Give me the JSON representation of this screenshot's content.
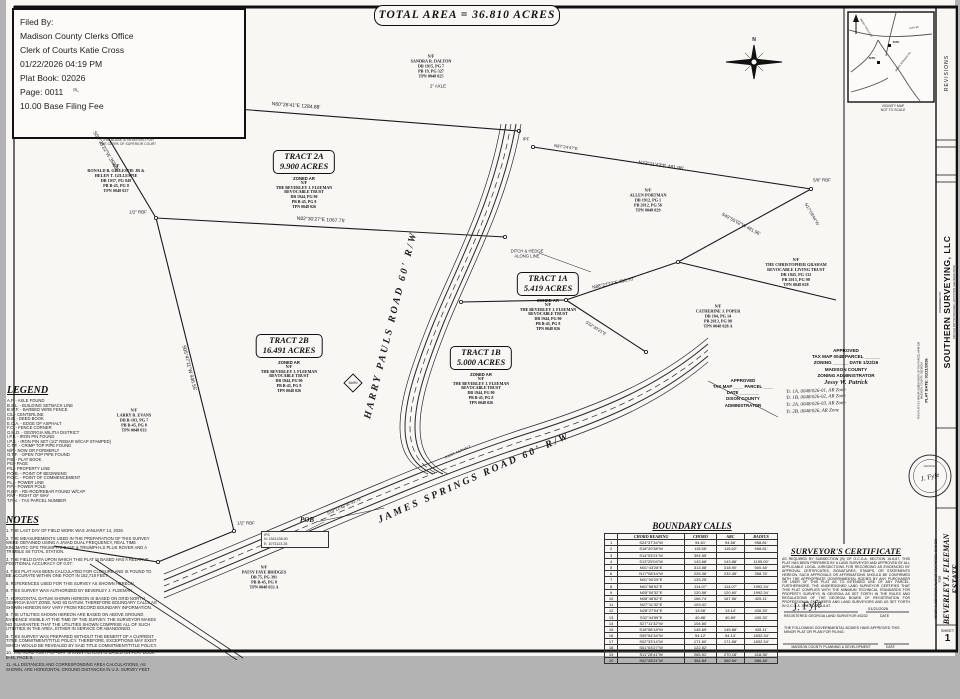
{
  "doc": {
    "total_area": "TOTAL AREA  =  36.810 ACRES",
    "sheet_label": "SHEET",
    "sheet_no": "1"
  },
  "filed_box": {
    "lines": [
      "Filed By:",
      "Madison County Clerks Office",
      "Clerk of Courts Katie Cross",
      "01/22/2026 04:19 PM",
      "Plat Book: 02026",
      "Page: 0011",
      "10.00 Base Filing Fee"
    ]
  },
  "clerk_caption": [
    "THIS BLANK IS RESERVED FOR",
    "THE CLERK OF SUPERIOR COURT"
  ],
  "compass": {
    "label": "N"
  },
  "vicinity": {
    "site1": "SITE",
    "site2": "SITE",
    "road1": "JAMES SPRINGS RD",
    "road2": "HARRY PAULS RD",
    "road3": "HWY 98",
    "cap1": "VICINITY MAP",
    "cap2": "NOT TO SCALE"
  },
  "title_block": {
    "revisions": "REVISIONS",
    "prepared_by": "PREPARED BY",
    "company": "SOUTHERN SURVEYING, LLC",
    "address": "198 OLD ROYSTON ROAD  •  ROYSTON, GEORGIA 30662",
    "plat_date": "PLAT DATE: 01/21/2026",
    "plat_note1": "THIS PLAT IS A MINOR SUBDIVISION OF TAX PARCEL 0048 026",
    "plat_note2": "MADISON COUNTY, GEORGIA",
    "seal_text": "GEORGIA",
    "seal_sig": "J. Fyfe",
    "project1": "MINOR SUBDIVISION PLAT OF TAX PARCEL 0048 026",
    "project2": "FOR",
    "client1": "BEVERLEY J. FLEEMAN",
    "client2": "ESTATE"
  },
  "roads": {
    "harry": "HARRY PAULS ROAD  60' R/W",
    "james": "JAMES SPRINGS ROAD  60' R/W"
  },
  "pob": {
    "lines": [
      "IPS",
      "N: 1541438.50",
      "E: 1073123.26"
    ]
  },
  "plat": {
    "tracts": [
      {
        "x": 298,
        "y": 150,
        "name": "TRACT  2A",
        "acres": "9.900 ACRES",
        "zoned": "ZONED AR",
        "owner": [
          "N/F",
          "THE BEVERLEY J. FLEEMAN",
          "REVOCABLE TRUST",
          "DB 1944, PG 90",
          "PB B-45, PG 8",
          "TPN 0048 026"
        ]
      },
      {
        "x": 542,
        "y": 272,
        "name": "TRACT  1A",
        "acres": "5.419 ACRES",
        "zoned": "ZONED AR",
        "owner": [
          "N/F",
          "THE BEVERLEY J. FLEEMAN",
          "REVOCABLE TRUST",
          "DB 1944, PG 90",
          "PB B-45, PG 8",
          "TPN 0048 026"
        ]
      },
      {
        "x": 283,
        "y": 334,
        "name": "TRACT  2B",
        "acres": "16.491 ACRES",
        "zoned": "ZONED AR",
        "owner": [
          "N/F",
          "THE BEVERLEY J. FLEEMAN",
          "REVOCABLE TRUST",
          "DB 1944, PG 90",
          "PB B-45, PG 8",
          "TPN 0048 026"
        ]
      },
      {
        "x": 475,
        "y": 346,
        "name": "TRACT  1B",
        "acres": "5.000 ACRES",
        "zoned": "ZONED AR",
        "owner": [
          "N/F",
          "THE BEVERLEY J. FLEEMAN",
          "REVOCABLE TRUST",
          "DB 1944, PG 90",
          "PB B-45, PG 8",
          "TPN 0048 026"
        ]
      }
    ],
    "neighbors": [
      {
        "x": 425,
        "y": 66,
        "lines": [
          "N/F",
          "SANDRA R. DALTON",
          "DB 1915, PG 7",
          "PB 19, PG 327",
          "TPN 0048 025"
        ]
      },
      {
        "x": 110,
        "y": 178,
        "lines": [
          "N/F",
          "RONALD B. GILLESPIE JR &",
          "HELEN T. GILLESPIE",
          "DB 1937, PG 849",
          "PB B-45, PG 8",
          "TPN 0048 027"
        ]
      },
      {
        "x": 642,
        "y": 200,
        "lines": [
          "N/F",
          "ALLEN PORTMAN",
          "DB 1912, PG 1",
          "PB 2012, PG 56",
          "TPN 0048 029"
        ]
      },
      {
        "x": 790,
        "y": 272,
        "lines": [
          "N/F",
          "THE CHRISTOPHER GRAHAM",
          "REVOCABLE LIVING TRUST",
          "DB 1845, PG 132",
          "PB 2015, PG 98",
          "TPN 0048 028"
        ]
      },
      {
        "x": 712,
        "y": 316,
        "lines": [
          "N/F",
          "CATHERINE J. POPER",
          "DB 184, PG 14",
          "PB 2013, PG 98",
          "TPN 0048 028 A"
        ]
      },
      {
        "x": 128,
        "y": 420,
        "lines": [
          "N/F",
          "LARRY R. EVANS",
          "DB B-103, PG 7",
          "PB B-45, PG 8",
          "TPN 0048 033"
        ]
      },
      {
        "x": 258,
        "y": 577,
        "lines": [
          "N/F",
          "PATSY FAYE BRIDGES",
          "DB 75, PG 391",
          "PB B-45, PG 8",
          "TPN 0048 033 A"
        ]
      }
    ],
    "labels": [
      {
        "t": "N60°26'41\"E  1284.88'",
        "x": 290,
        "y": 106,
        "r": 4,
        "fs": 5
      },
      {
        "t": "N82°30'27\"E  1067.75'",
        "x": 315,
        "y": 220,
        "r": 3,
        "fs": 5
      },
      {
        "t": "N73°11'43\"E  481.96'",
        "x": 655,
        "y": 166,
        "r": 8,
        "fs": 5
      },
      {
        "t": "S05°47'11\"W  946.55'",
        "x": 183,
        "y": 368,
        "r": 76,
        "fs": 5
      },
      {
        "t": "S59°38'22\"W  358.86'",
        "x": 100,
        "y": 152,
        "r": 59,
        "fs": 5
      },
      {
        "t": "N88°27'23\"E  353.70'",
        "x": 607,
        "y": 283,
        "r": -12,
        "fs": 4.6
      },
      {
        "t": "S40°55'02\"W  481.96'",
        "x": 735,
        "y": 224,
        "r": 28,
        "fs": 4.6
      },
      {
        "t": "N17°08'44\"W",
        "x": 806,
        "y": 214,
        "r": 60,
        "fs": 4.2
      },
      {
        "t": "S32°30'21\"E",
        "x": 590,
        "y": 328,
        "r": 32,
        "fs": 4.2
      },
      {
        "t": "N87°24'47\"E",
        "x": 560,
        "y": 147,
        "r": 8,
        "fs": 4.2
      },
      {
        "t": "S18°12'48\"W  93.79'",
        "x": 338,
        "y": 506,
        "r": -24,
        "fs": 4.2
      },
      {
        "t": "2\" AXLE",
        "x": 432,
        "y": 86,
        "r": 0,
        "fs": 4.4
      },
      {
        "t": "PL",
        "x": 70,
        "y": 90,
        "r": 0,
        "fs": 4.4
      },
      {
        "t": "1/2\" RBF",
        "x": 132,
        "y": 212,
        "r": 0,
        "fs": 4.4
      },
      {
        "t": "IPF",
        "x": 520,
        "y": 139,
        "r": 0,
        "fs": 4.2
      },
      {
        "t": "5/8\" RBF",
        "x": 816,
        "y": 180,
        "r": 0,
        "fs": 4.4
      },
      {
        "t": "1/2\" RBF",
        "x": 240,
        "y": 523,
        "r": 0,
        "fs": 4.4
      },
      {
        "t": "DITCH & HEDGE",
        "x": 521,
        "y": 251,
        "r": 0,
        "fs": 4.2
      },
      {
        "t": "ALONG LINE",
        "x": 521,
        "y": 256,
        "r": 0,
        "fs": 4.2
      },
      {
        "t": "POB",
        "x": 301,
        "y": 520,
        "r": 0,
        "fs": 7,
        "b": 1,
        "i": 1,
        "sf": 1
      },
      {
        "t": "EXIST. ASPHALT",
        "x": 452,
        "y": 452,
        "r": -24,
        "fs": 3.6
      },
      {
        "t": "BARN",
        "x": 347,
        "y": 383,
        "r": 0,
        "fs": 3.2
      }
    ]
  },
  "legend": {
    "title": "LEGEND",
    "items": [
      "A.F.  -  AXLE FOUND",
      "B.S.L.  -  BUILDING SETBACK LINE",
      "B.W.F.  -  BARBED WIRE FENCE",
      "C/L  -  CENTERLINE",
      "D.B.  -  DEED BOOK",
      "E.O.A.  -  EDGE OF ASPHALT",
      "F.C.  -  FENCE CORNER",
      "G.M.D.  -  GEORGIA MILITIA DISTRICT",
      "I.P.F.  -  IRON PIN FOUND",
      "I.P.S.  -  IRON PIN SET (1/2\" REBAR W/CAP STAMPED)",
      "C.T.F.  -  CRIMP TOP PIPE FOUND",
      "N/F  -  NOW OR FORMERLY",
      "O.T.F.  -  OPEN TOP PIPE FOUND",
      "P.B.  -  PLAT BOOK",
      "PG  -  PAGE",
      "P/L  -  PROPERTY LINE",
      "P.O.B.  -  POINT OF BEGINNING",
      "P.O.C.  -  POINT OF COMMENCEMENT",
      "P.L.  -  POWER LINE",
      "P.P.  -  POWER POLE",
      "R.B.F.  -  RE-ROD/REBAR FOUND W/CAP",
      "R/W  -  RIGHT OF WAY",
      "T.P.N.  -  TAX PARCEL NUMBER"
    ]
  },
  "notes": {
    "title": "NOTES",
    "items": [
      "1.  THE LAST DAY OF FIELD WORK WAS JANUARY 14, 2026.",
      "2.  THE MEASUREMENTS USED IN THE PREPARATION OF THIS SURVEY WERE OBTAINED USING A JAVAD DUAL FREQUENCY, REAL TIME KINEMATIC GPS TRIUMPH-2 BASE & TRIUMPH-LS PLUS ROVER AND A TRIMBLE S6 TOTAL STATION.",
      "3.  THE FIELD DATA UPON WHICH THIS PLAT IS BASED HAS A RELATIVE POSITIONAL ACCURACY OF 0.07'.",
      "4.  THIS PLAT HAS BEEN CALCULATED FOR CLOSURE AND IS FOUND TO BE ACCURATE WITHIN ONE FOOT IN 152,718 FEET.",
      "5.  REFERENCES USED FOR THIS SURVEY AS SHOWN HEREON.",
      "6.  THIS SURVEY WAS AUTHORIZED BY BEVERLEY J. FLEEMAN.",
      "7.  HORIZONTAL DATUM SHOWN HEREON IS BASED ON GRID NORTH GEORGIA EAST ZONE, NAD 83 DATUM. THEREFORE BOUNDARY CALLS AS SHOWN HEREON MAY VARY FROM RECORD BOUNDARY INFORMATION.",
      "8.  THE UTILITIES SHOWN HEREON ARE BASED ON ABOVE GROUND EVIDENCE VISIBLE AT THE TIME OF THE SURVEY. THE SURVEYOR MAKES NO GUARANTEE THAT THE UTILITIES SHOWN COMPRISE ALL OF SUCH UTILITIES IN THE AREA, EITHER IN SERVICE OR ABANDONED.",
      "9.  THIS SURVEY WAS PREPARED WITHOUT THE BENEFIT OF A CURRENT TITLE COMMITMENT/TITLE POLICY. THEREFORE, EXCEPTIONS MAY EXIST WHICH WOULD BE REVEALED BY SAID TITLE COMMITMENT/TITLE POLICY.",
      "10.  THE ROAD RIGHT-OF-WAY SHOWN HEREON IS BASED ON PLAT BOOK B-45, PAGE 8.",
      "11.  ALL DISTANCES AND CORRESPONDING AREA CALCULATIONS, AS SHOWN, ARE HORIZONTAL GROUND DISTANCES IN U.S. SURVEY FEET."
    ]
  },
  "boundary_calls": {
    "title": "BOUNDARY CALLS",
    "headers": [
      "",
      "CHORD BEARING",
      "CHORD",
      "ARC",
      "RADIUS"
    ],
    "rows": [
      [
        "1",
        "S24°37'34\"W",
        "94.61'",
        "94.66'",
        "958.81'"
      ],
      [
        "2",
        "S18°20'38\"W",
        "115.55'",
        "115.62'",
        "958.81'"
      ],
      [
        "3",
        "S14°53'21\"W",
        "394.55'",
        "",
        ""
      ],
      [
        "4",
        "S13°25'04\"W",
        "143.68'",
        "143.88'",
        "1155.00'"
      ],
      [
        "5",
        "N01°43'28\"E",
        "313.58'",
        "318.90'",
        "500.48'"
      ],
      [
        "6",
        "N17°08'44\"W",
        "228.36'",
        "232.45'",
        "358.76'"
      ],
      [
        "7",
        "N01°00'29\"E",
        "133.25'",
        "",
        ""
      ],
      [
        "8",
        "N01°58'52\"E",
        "114.07'",
        "114.07'",
        "1992.34'"
      ],
      [
        "9",
        "N05°00'32\"E",
        "120.56'",
        "120.60'",
        "1992.34'"
      ],
      [
        "10",
        "N08°48'52\"E",
        "166.74'",
        "167.56'",
        "425.11'"
      ],
      [
        "11",
        "N27°11'32\"E",
        "103.41'",
        "",
        ""
      ],
      [
        "12",
        "N28°27'04\"E",
        "13.06'",
        "13.14'",
        "430.33'"
      ],
      [
        "13",
        "S32°44'59\"E",
        "40.86'",
        "40.89'",
        "430.33'"
      ],
      [
        "14",
        "S27°11'32\"W",
        "104.80'",
        "",
        ""
      ],
      [
        "15",
        "S18°58'18\"W",
        "145.69'",
        "145.88'",
        "435.11'"
      ],
      [
        "16",
        "S05°54'34\"W",
        "54.12'",
        "54.13'",
        "1832.34'"
      ],
      [
        "17",
        "S02°33'14\"W",
        "171.60'",
        "171.68'",
        "1832.34'"
      ],
      [
        "18",
        "S01°03'27\"W",
        "122.52'",
        "",
        ""
      ],
      [
        "19",
        "S11°28'41\"W",
        "265.51'",
        "270.18'",
        "418.36'"
      ],
      [
        "20",
        "S02°28'21\"W",
        "354.84'",
        "360.54'",
        "586.48'"
      ]
    ]
  },
  "certificate": {
    "title": "SURVEYOR'S CERTIFICATE",
    "body": "AS REQUIRED BY SUBSECTION (B) OF O.C.G.A. SECTION 15-6-67, THIS PLAT HAS BEEN PREPARED BY A LAND SURVEYOR AND APPROVED BY ALL APPLICABLE LOCAL JURISDICTIONS FOR RECORDING AS EVIDENCED BY APPROVAL CERTIFICATES, SIGNATURES, STAMPS, OR STATEMENTS HEREON. SUCH APPROVALS OR AFFIRMATIONS SHOULD BE CONFIRMED WITH THE APPROPRIATE GOVERNMENTAL BODIES BY ANY PURCHASER OR USER OF THIS PLAT AS TO INTENDED USE OF ANY PARCEL. FURTHERMORE, THE UNDERSIGNED LAND SURVEYOR CERTIFIES THAT THIS PLAT COMPLIES WITH THE MINIMUM TECHNICAL STANDARDS FOR PROPERTY SURVEYS IN GEORGIA AS SET FORTH IN THE RULES AND REGULATIONS OF THE GEORGIA BOARD OF REGISTRATION FOR PROFESSIONAL ENGINEERS AND LAND SURVEYORS AND AS SET FORTH IN O.C.G.A. SECTION 15-6-67.",
    "signature": "J. Fyfe",
    "sig_title": "REGISTERED GEORGIA LAND SURVEYOR #3232",
    "date": "01/21/2026",
    "date_label": "DATE",
    "approval_note": "THE FOLLOWING GOVERNMENTAL BODIES HAVE APPROVED THIS MINOR PLAT OR PLAN FOR FILING:",
    "approval_line": "MADISON COUNTY PLANNING & DEVELOPMENT",
    "approval_date_label": "DATE"
  },
  "approvals": {
    "madison": {
      "lines": [
        "APPROVED",
        "TAX MAP 0048  PARCEL ______",
        "ZONING ______   DATE 1/22/26",
        "MADISON COUNTY",
        "ZONING ADMINISTRATOR"
      ],
      "signature": "Jessy W. Patrick",
      "hand_notes": [
        "Tr. 1A, 0048/026-01, AR Zone",
        "Tr. 1B, 0048/026-02, AR Zone",
        "Tr. 2A, 0048/026-03, AR Zone",
        "Tr. 2B, 0048/026, AR Zone"
      ]
    },
    "other": {
      "lines": [
        "APPROVED",
        "TAX MAP ____ PARCEL ____",
        "DATE ________",
        "DIXON COUNTY",
        "ADMINISTRATOR"
      ]
    }
  }
}
